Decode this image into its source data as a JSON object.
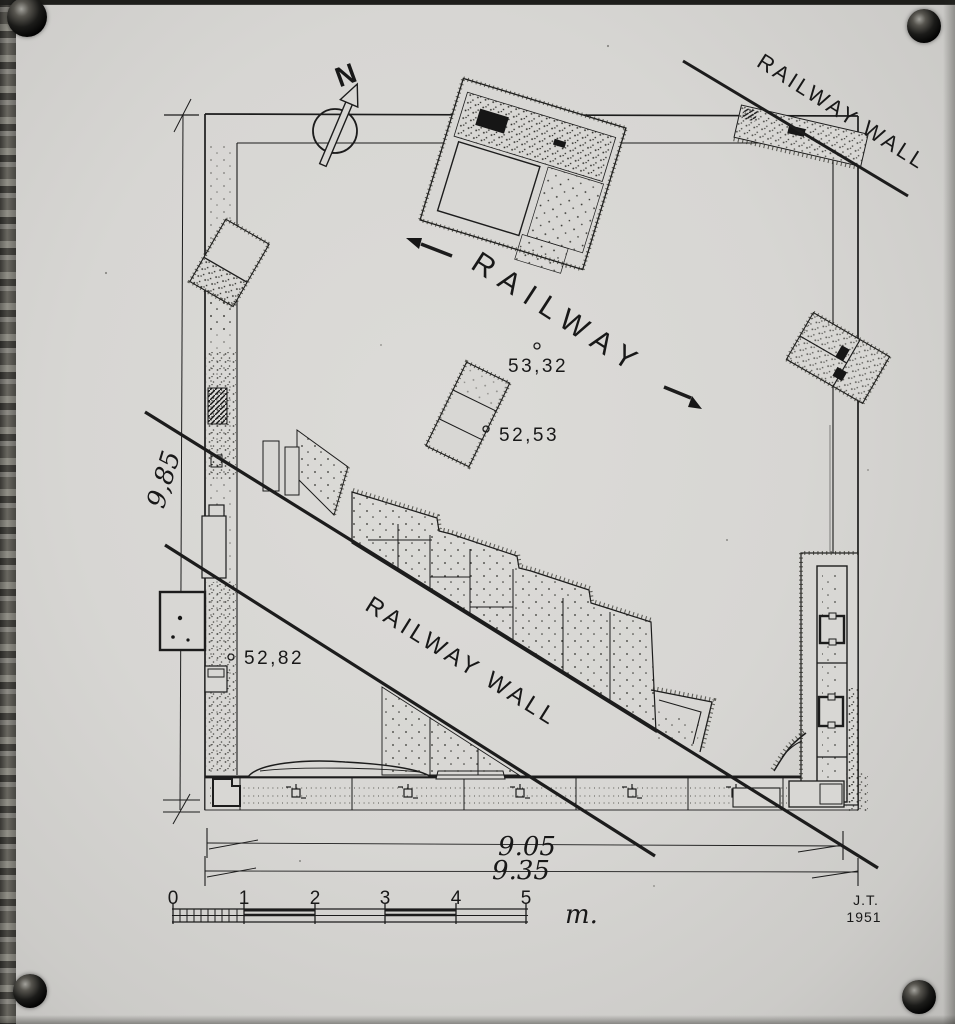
{
  "plan": {
    "labels": {
      "railway": "RAILWAY",
      "railway_wall_upper_right": "RAILWAY WALL",
      "railway_wall_lower": "RAILWAY WALL"
    },
    "north_arrow": {
      "label": "N"
    },
    "spot_elevations": [
      {
        "value": "53,32"
      },
      {
        "value": "52,53"
      },
      {
        "value": "52,82"
      }
    ],
    "dimensions": {
      "left_height": "9,85",
      "bottom_width_inner": "9.05",
      "bottom_width_outer": "9.35"
    },
    "scale_bar": {
      "tick_labels": [
        "0",
        "1",
        "2",
        "3",
        "4",
        "5"
      ],
      "unit_label": "m."
    },
    "signature": {
      "initials": "J.T.",
      "year": "1951"
    }
  },
  "colors": {
    "paper": "#d8d7d4",
    "ink": "#1b1b1b",
    "background": "#20201e"
  }
}
